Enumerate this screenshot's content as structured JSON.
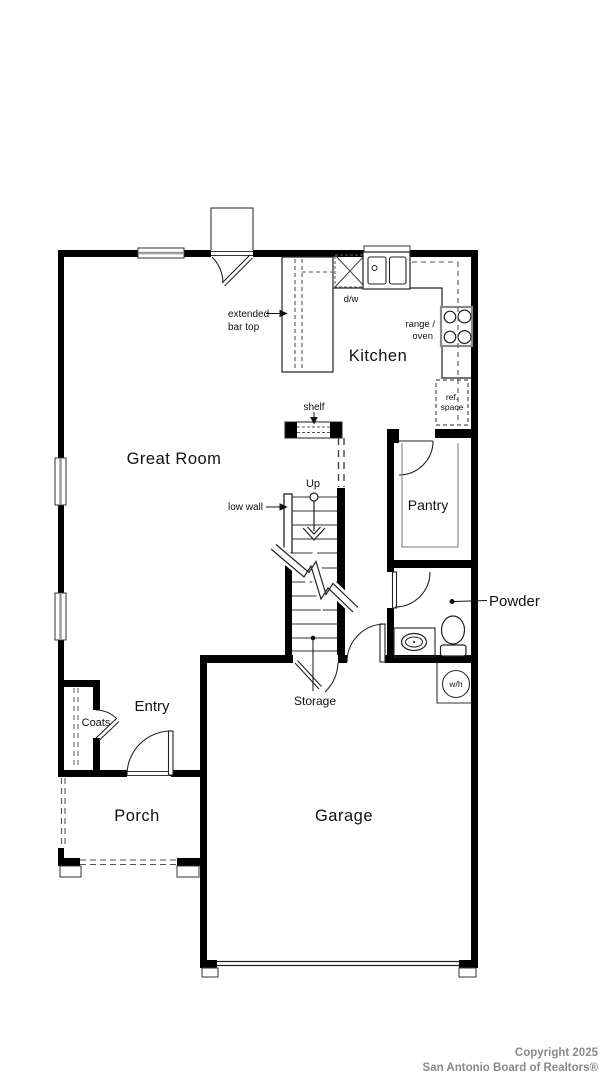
{
  "rooms": {
    "great_room": "Great Room",
    "kitchen": "Kitchen",
    "pantry": "Pantry",
    "powder": "Powder",
    "entry": "Entry",
    "coats": "Coats",
    "porch": "Porch",
    "garage": "Garage",
    "storage": "Storage"
  },
  "annotations": {
    "extended_bar_top_1": "extended",
    "extended_bar_top_2": "bar top",
    "dishwasher": "d/w",
    "range_oven_1": "range /",
    "range_oven_2": "oven",
    "ref_space_1": "ref.",
    "ref_space_2": "space",
    "shelf": "shelf",
    "up": "Up",
    "low_wall": "low wall",
    "water_heater": "w/h"
  },
  "footer": {
    "line1": "Copyright 2025",
    "line2": "San Antonio Board of Realtors®"
  },
  "colors": {
    "wall": "#000000",
    "thin_line": "#222222",
    "dashed_line": "#555555",
    "window_glass": "#999999",
    "footer_text": "#8a8a8a"
  }
}
